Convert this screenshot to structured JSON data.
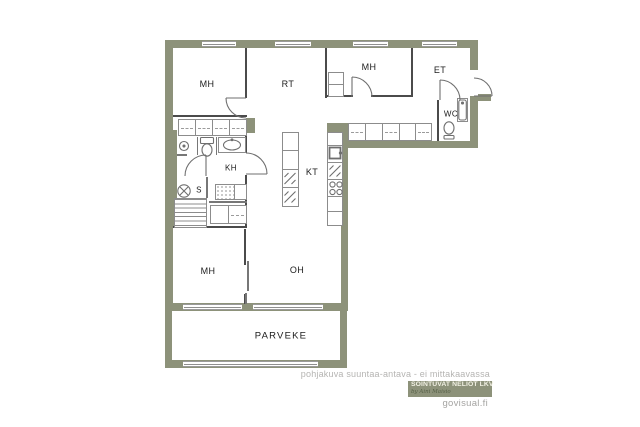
{
  "rooms": {
    "mh1": "MH",
    "rt": "RT",
    "mh2": "MH",
    "et": "ET",
    "wc": "WC",
    "kh": "KH",
    "s": "S",
    "kt": "KT",
    "mh3": "MH",
    "oh": "OH",
    "parveke": "PARVEKE"
  },
  "footer": {
    "disclaimer": "pohjakuva suuntaa-antava - ei mittakaavassa",
    "brand": "SOINTUVAT NELIÖT LKV",
    "brand_tagline": "by Aini Maisio",
    "site": "govisual.fi"
  },
  "colors": {
    "exterior_wall": "#8D927A",
    "interior_wall": "#4B4B4B",
    "fixture_stroke": "#8C8C8C",
    "label_text": "#1C1C1C",
    "disclaimer_text": "#B5B4B2",
    "badge_bg": "#8D927A",
    "badge_text": "#F2F1E4",
    "site_text": "#A5A4A2"
  },
  "icons": {
    "door-icon": "quarter-circle arc",
    "window-icon": "white strip with frame line",
    "toilet-icon": "tank rectangle + bowl ellipse",
    "sink-icon": "oval basin with faucet dot",
    "shower-icon": "circle shower rose",
    "sauna-stove-icon": "circle with X",
    "stove-icon": "four burner circles",
    "appliance-icon": "double diagonal (fridge/dishwasher)",
    "wardrobe-icon": "cell with dashed rail",
    "sauna-benches-icon": "horizontal slats",
    "shower-floor-icon": "speckled square"
  }
}
